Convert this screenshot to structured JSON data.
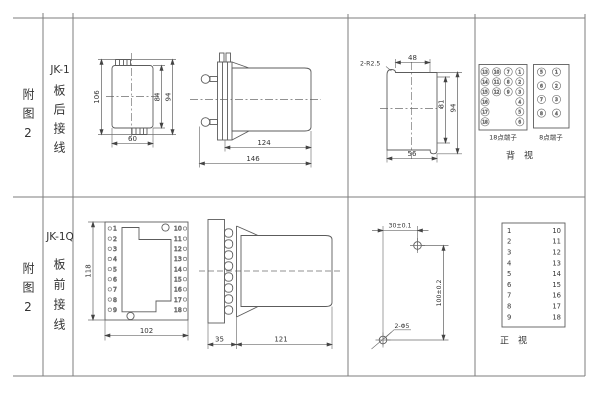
{
  "row1": {
    "fig_label": "附图2",
    "model": "JK-1",
    "wiring": "板后接线",
    "front_view": {
      "dim_height": "106",
      "dim_inner": "84",
      "dim_outer": "94",
      "dim_width": "60"
    },
    "side_view": {
      "dim_body": "124",
      "dim_total": "146"
    },
    "cutout": {
      "dim_corner": "2-R2.5",
      "dim_top": "48",
      "dim_inner": "81",
      "dim_outer": "94",
      "dim_bottom": "56"
    },
    "terminals": {
      "label_18": "18点端子",
      "label_8": "8点端子",
      "view_label": "背视",
      "t18_cols": [
        [
          13,
          14,
          15,
          16,
          17,
          18
        ],
        [
          10,
          11,
          12
        ],
        [
          7,
          8,
          9
        ],
        [
          1,
          2,
          3,
          4,
          5,
          6
        ]
      ],
      "t8_cols": [
        [
          5,
          6,
          7,
          8
        ],
        [
          1,
          2,
          3,
          4
        ]
      ]
    }
  },
  "row2": {
    "fig_label": "附图2",
    "model": "JK-1Q",
    "wiring": "板前接线",
    "front_view": {
      "dim_height": "118",
      "dim_width": "102",
      "left_terminals": [
        1,
        2,
        3,
        4,
        5,
        6,
        7,
        8,
        9
      ],
      "right_terminals": [
        10,
        11,
        12,
        13,
        14,
        15,
        16,
        17,
        18
      ]
    },
    "side_view": {
      "dim_flange": "35",
      "dim_body": "121"
    },
    "drill": {
      "dim_h": "30±0.1",
      "dim_v": "100±0.2",
      "dim_holes": "2-Φ5"
    },
    "table": {
      "left": [
        1,
        2,
        3,
        4,
        5,
        6,
        7,
        8,
        9
      ],
      "right": [
        10,
        11,
        12,
        13,
        14,
        15,
        16,
        17,
        18
      ],
      "view_label": "正视"
    }
  }
}
